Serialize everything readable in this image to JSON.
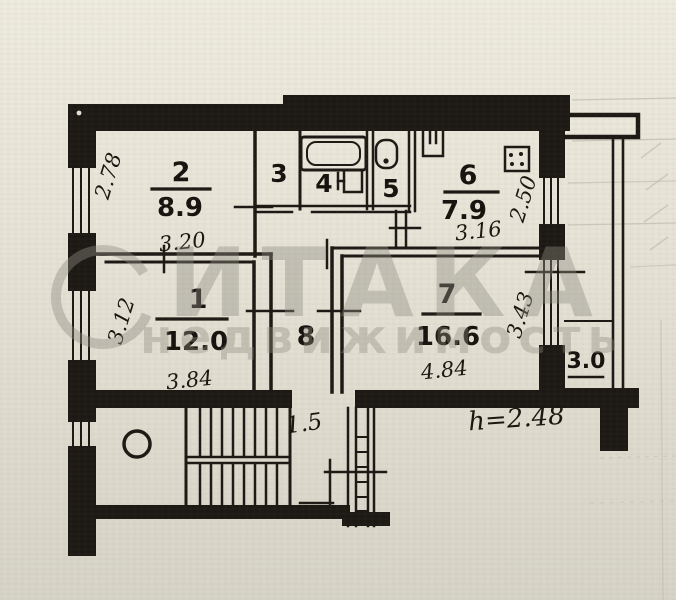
{
  "document": {
    "type": "apartment-floor-plan-scan"
  },
  "watermark": {
    "brand": "ИТАКА",
    "subtitle": "недвижимость"
  },
  "rooms": {
    "r1": {
      "number": "1",
      "area": "12.0",
      "width": "3.84",
      "depth": "3.12"
    },
    "r2": {
      "number": "2",
      "area": "8.9",
      "width": "3.20",
      "depth": "2.78"
    },
    "r3": {
      "number": "3"
    },
    "r4": {
      "number": "4"
    },
    "r5": {
      "number": "5"
    },
    "r6": {
      "number": "6",
      "area": "7.9",
      "width": "3.16",
      "depth": "2.50"
    },
    "r7": {
      "number": "7",
      "area": "16.6",
      "width": "4.84",
      "depth": "3.43"
    },
    "r8": {
      "number": "8"
    },
    "balcony": {
      "area": "3.0"
    }
  },
  "annotations": {
    "ceiling_height": "h=2.48",
    "passage_width": "1.5"
  },
  "colors": {
    "paper": "#e7e3d7",
    "ink": "#1c1813",
    "watermark": "#8f8d82"
  }
}
